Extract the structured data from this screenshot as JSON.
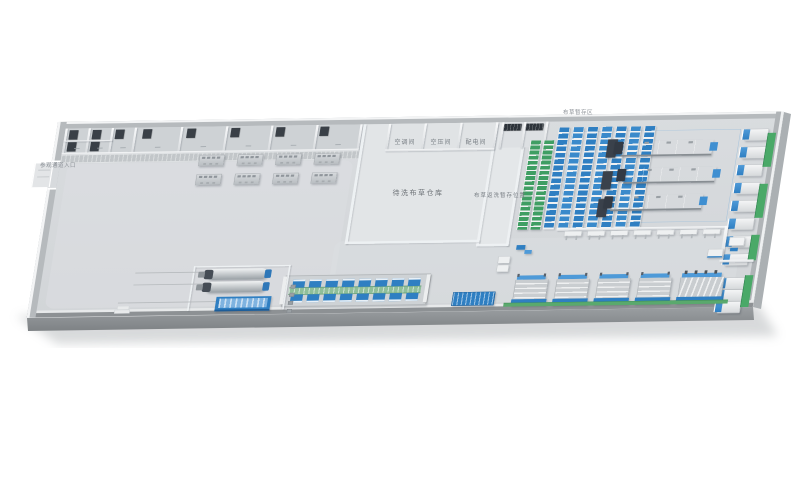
{
  "scene": {
    "description": "3D isometric layout rendering of a commercial laundry factory floor",
    "background": "#ffffff"
  },
  "labels": {
    "entrance": "参观通道入口",
    "utility_rooms": [
      "空调间",
      "空压间",
      "配电间"
    ],
    "warehouse": "待洗布草仓库",
    "rewash_area": "布草返洗暂存位置",
    "storage_area": "布草暂存区"
  },
  "equipment": {
    "office_rooms": 8,
    "workstation_clusters": 8,
    "storage_rack_columns": 7,
    "green_shelf_columns": 2,
    "tunnel_dryers": 3,
    "wall_washers_group1": 8,
    "wall_washers_group2": 3,
    "inspection_tables": 7,
    "ironer_lines": 4,
    "ironer_lines_wide": 1,
    "assembly_stations_per_row": 8,
    "cylinder_machines": 2
  },
  "colors": {
    "machine_blue": "#2f7fc2",
    "machine_blue_light": "#4e9ad8",
    "accent_green": "#4aa968",
    "rack_green": "#3f9e63",
    "floor": "#d7dadd",
    "floor_room": "#e2e5e7",
    "wall_face": "#b6babd",
    "wall_top": "#f3f4f5",
    "metal": "#c3c7ca",
    "metal_dark": "#878d92",
    "dark_unit": "#333a44",
    "slab_side": "#8d9194"
  }
}
